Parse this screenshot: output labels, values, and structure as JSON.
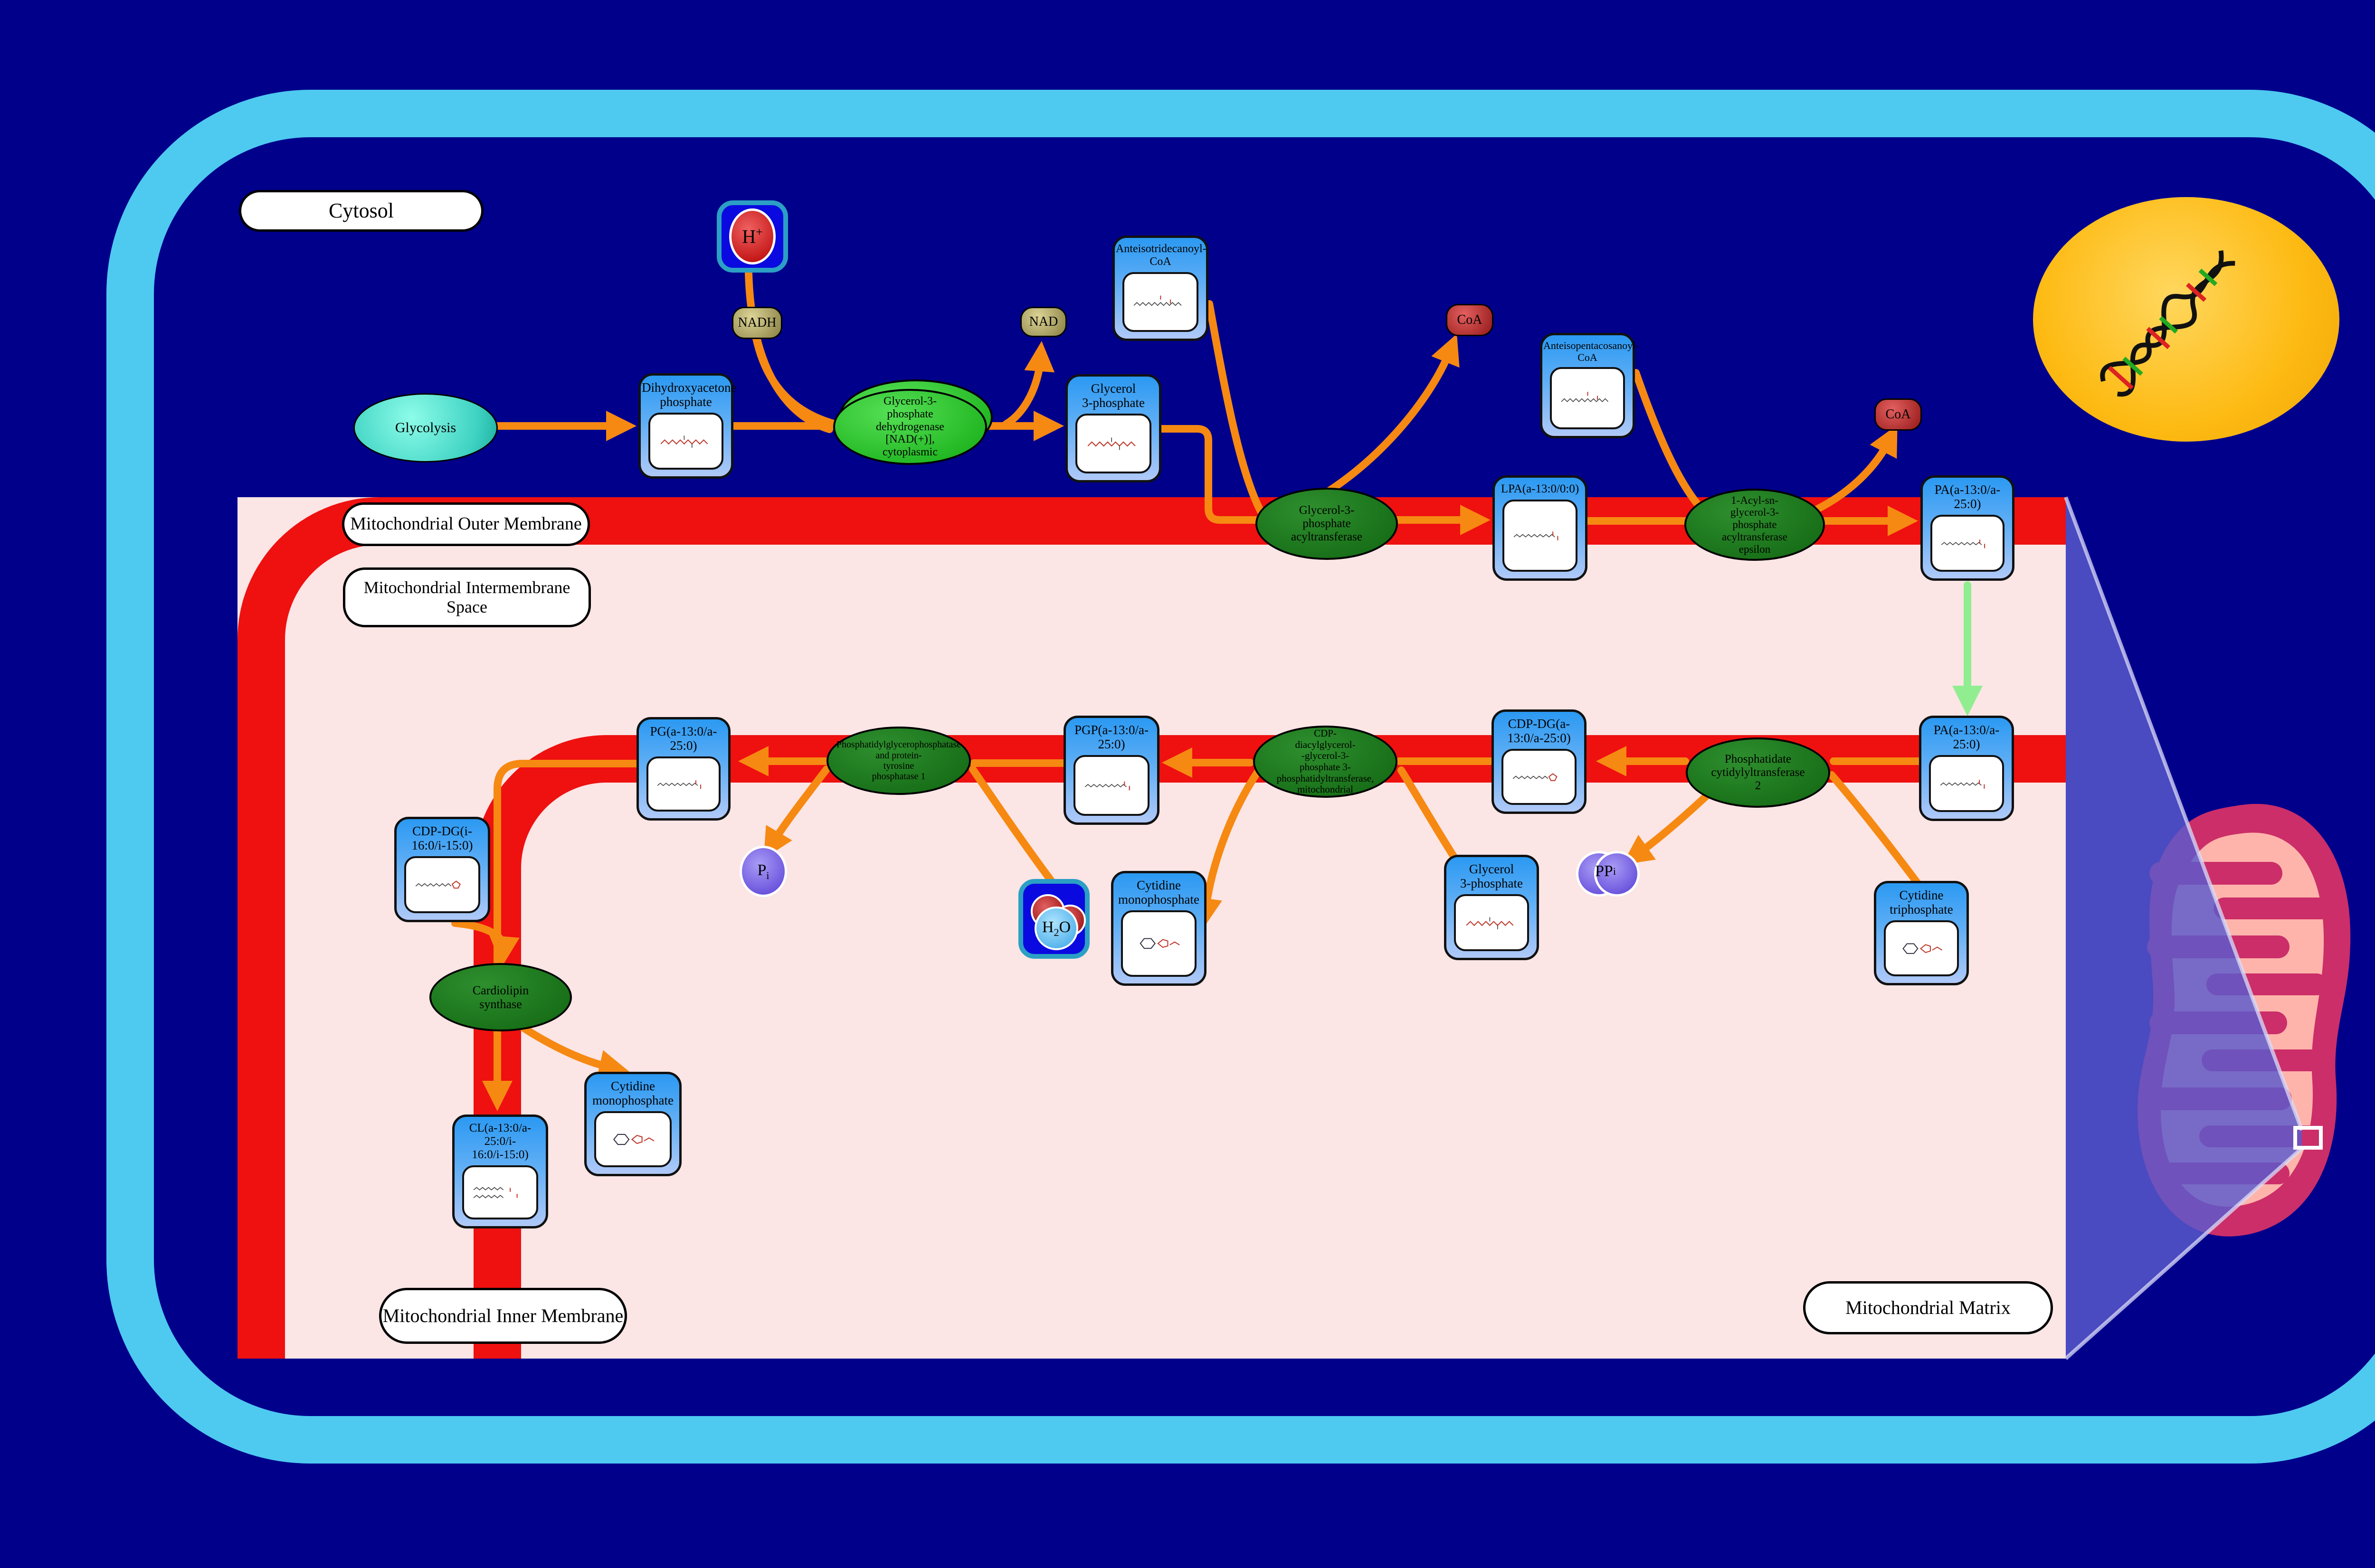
{
  "compartments": {
    "cytosol": "Cytosol",
    "outer_membrane": "Mitochondrial Outer Membrane",
    "intermembrane_space": "Mitochondrial Intermembrane\nSpace",
    "inner_membrane": "Mitochondrial Inner Membrane",
    "matrix": "Mitochondrial Matrix"
  },
  "source": {
    "glycolysis": "Glycolysis"
  },
  "metabolites": {
    "dhap": "Dihydroxyacetone\nphosphate",
    "g3p_cytosol": "Glycerol\n3-phosphate",
    "acoa13": "Anteisotridecanoyl-\nCoA",
    "acoa25": "Anteisopentacosanoyl-\nCoA",
    "lpa": "LPA(a-13:0/0:0)",
    "pa_outer": "PA(a-13:0/a-\n25:0)",
    "pa_inner": "PA(a-13:0/a-\n25:0)",
    "cdp_dg_a": "CDP-DG(a-\n13:0/a-25:0)",
    "g3p_matrix": "Glycerol\n3-phosphate",
    "pgp": "PGP(a-13:0/a-\n25:0)",
    "pg": "PG(a-13:0/a-\n25:0)",
    "cdp_dg_i": "CDP-DG(i-\n16:0/i-15:0)",
    "cl": "CL(a-13:0/a-\n25:0/i-\n16:0/i-15:0)",
    "cmp_1": "Cytidine\nmonophosphate",
    "cmp_2": "Cytidine\nmonophosphate",
    "ctp": "Cytidine\ntriphosphate"
  },
  "enzymes": {
    "gpd": "Glycerol-3-\nphosphate\ndehydrogenase\n[NAD(+)],\ncytoplasmic",
    "gpat": "Glycerol-3-\nphosphate\nacyltransferase",
    "agpat": "1-Acyl-sn-\nglycerol-3-\nphosphate\nacyltransferase\nepsilon",
    "pct2": "Phosphatidate\ncytidylyltransferase\n2",
    "pgps": "CDP-\ndiacylglycerol-\n-glycerol-3-\nphosphate 3-\nphosphatidyltransferase,\nmitochondrial",
    "pgpase": "Phosphatidylglycerophosphatase\nand protein-\ntyrosine\nphosphatase 1",
    "cls": "Cardiolipin\nsynthase"
  },
  "cofactors": {
    "nadh": "NADH",
    "nad": "NAD",
    "coa_1": "CoA",
    "coa_2": "CoA",
    "pi_base": "P",
    "pi_sub": "i",
    "ppi_base": "PP",
    "ppi_sub": "i",
    "h_base": "H",
    "h_sup": "+",
    "h2o_h": "H",
    "h2o_sub": "2",
    "h2o_o": "O"
  },
  "colors": {
    "background": "#00008B",
    "cell_wall": "#4EC9F0",
    "matrix_pink": "#FBE5E5",
    "membrane_red": "#EF1010",
    "arrow_orange": "#F68912",
    "arrow_green": "#90EE90",
    "box_blue_top": "#2B99F2",
    "box_blue_bottom": "#AFC9F8",
    "enzyme_green": "#176E17",
    "enzyme_green_bright": "#2FC52F",
    "nucleus_gold": "#FDBA12",
    "mito_body": "#CB2E68",
    "mito_cristae": "#FFB4AB",
    "zoom_beam": "#5A5ACD"
  }
}
